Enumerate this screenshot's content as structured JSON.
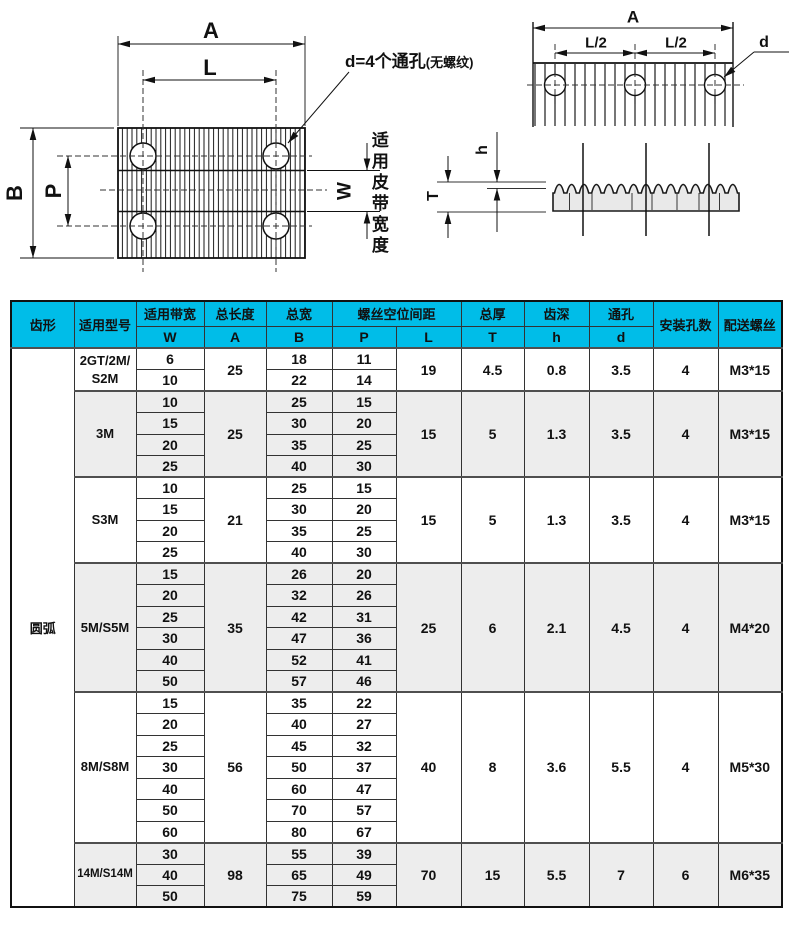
{
  "colors": {
    "header_bg": "#00bde8",
    "shade_bg": "#ededed",
    "drawing_fill": "#e9e9e9"
  },
  "drawing": {
    "labels": {
      "A_left": "A",
      "L_left": "L",
      "B": "B",
      "P": "P",
      "W": "W",
      "belt_width_note": "适用皮带宽度",
      "hole_note_main": "d=4个通孔",
      "hole_note_paren": "(无螺纹)",
      "A_right": "A",
      "L2_left": "L/2",
      "L2_right": "L/2",
      "d": "d",
      "h": "h",
      "T": "T"
    }
  },
  "table": {
    "tooth_profile": "圆弧",
    "header": {
      "tooth": "齿形",
      "model": "适用型号",
      "bandwidth": "适用带宽",
      "total_length": "总长度",
      "total_width": "总宽",
      "screw_spacing": "螺丝空位间距",
      "thickness": "总厚",
      "tooth_depth": "齿深",
      "through_hole": "通孔",
      "mount_holes": "安装孔数",
      "screws": "配送螺丝",
      "sub": {
        "w": "W",
        "a": "A",
        "b": "B",
        "p": "P",
        "l": "L",
        "t": "T",
        "h": "h",
        "d": "d"
      }
    },
    "groups": [
      {
        "model": "2GT/2M/\nS2M",
        "shade": false,
        "small": false,
        "rows": [
          {
            "w": "6",
            "b": "18",
            "p": "11"
          },
          {
            "w": "10",
            "b": "22",
            "p": "14"
          }
        ],
        "a": "25",
        "l": "19",
        "t": "4.5",
        "h": "0.8",
        "d": "3.5",
        "holes": "4",
        "screw": "M3*15"
      },
      {
        "model": "3M",
        "shade": true,
        "small": false,
        "rows": [
          {
            "w": "10",
            "b": "25",
            "p": "15"
          },
          {
            "w": "15",
            "b": "30",
            "p": "20"
          },
          {
            "w": "20",
            "b": "35",
            "p": "25"
          },
          {
            "w": "25",
            "b": "40",
            "p": "30"
          }
        ],
        "a": "25",
        "l": "15",
        "t": "5",
        "h": "1.3",
        "d": "3.5",
        "holes": "4",
        "screw": "M3*15"
      },
      {
        "model": "S3M",
        "shade": false,
        "small": false,
        "rows": [
          {
            "w": "10",
            "b": "25",
            "p": "15"
          },
          {
            "w": "15",
            "b": "30",
            "p": "20"
          },
          {
            "w": "20",
            "b": "35",
            "p": "25"
          },
          {
            "w": "25",
            "b": "40",
            "p": "30"
          }
        ],
        "a": "21",
        "l": "15",
        "t": "5",
        "h": "1.3",
        "d": "3.5",
        "holes": "4",
        "screw": "M3*15"
      },
      {
        "model": "5M/S5M",
        "shade": true,
        "small": false,
        "rows": [
          {
            "w": "15",
            "b": "26",
            "p": "20"
          },
          {
            "w": "20",
            "b": "32",
            "p": "26"
          },
          {
            "w": "25",
            "b": "42",
            "p": "31"
          },
          {
            "w": "30",
            "b": "47",
            "p": "36"
          },
          {
            "w": "40",
            "b": "52",
            "p": "41"
          },
          {
            "w": "50",
            "b": "57",
            "p": "46"
          }
        ],
        "a": "35",
        "l": "25",
        "t": "6",
        "h": "2.1",
        "d": "4.5",
        "holes": "4",
        "screw": "M4*20"
      },
      {
        "model": "8M/S8M",
        "shade": false,
        "small": false,
        "rows": [
          {
            "w": "15",
            "b": "35",
            "p": "22"
          },
          {
            "w": "20",
            "b": "40",
            "p": "27"
          },
          {
            "w": "25",
            "b": "45",
            "p": "32"
          },
          {
            "w": "30",
            "b": "50",
            "p": "37"
          },
          {
            "w": "40",
            "b": "60",
            "p": "47"
          },
          {
            "w": "50",
            "b": "70",
            "p": "57"
          },
          {
            "w": "60",
            "b": "80",
            "p": "67"
          }
        ],
        "a": "56",
        "l": "40",
        "t": "8",
        "h": "3.6",
        "d": "5.5",
        "holes": "4",
        "screw": "M5*30"
      },
      {
        "model": "14M/S14M",
        "shade": true,
        "small": true,
        "rows": [
          {
            "w": "30",
            "b": "55",
            "p": "39"
          },
          {
            "w": "40",
            "b": "65",
            "p": "49"
          },
          {
            "w": "50",
            "b": "75",
            "p": "59"
          }
        ],
        "a": "98",
        "l": "70",
        "t": "15",
        "h": "5.5",
        "d": "7",
        "holes": "6",
        "screw": "M6*35"
      }
    ]
  }
}
